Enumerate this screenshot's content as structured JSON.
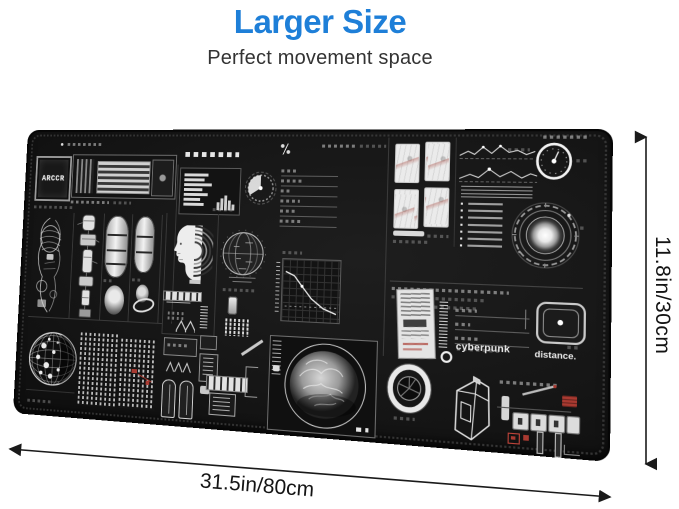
{
  "header": {
    "title": "Larger Size",
    "subtitle": "Perfect movement space",
    "title_color": "#1e7fd8"
  },
  "dimensions": {
    "width_label": "31.5in/80cm",
    "height_label": "11.8in/30cm"
  },
  "pad": {
    "logo_text": "ARCCR",
    "brand_text": "cyberpunk",
    "brand_text_2": "distance.",
    "surface_color": "#161616",
    "accent_red": "#a93a31",
    "ink_white": "#e8e8e8"
  }
}
